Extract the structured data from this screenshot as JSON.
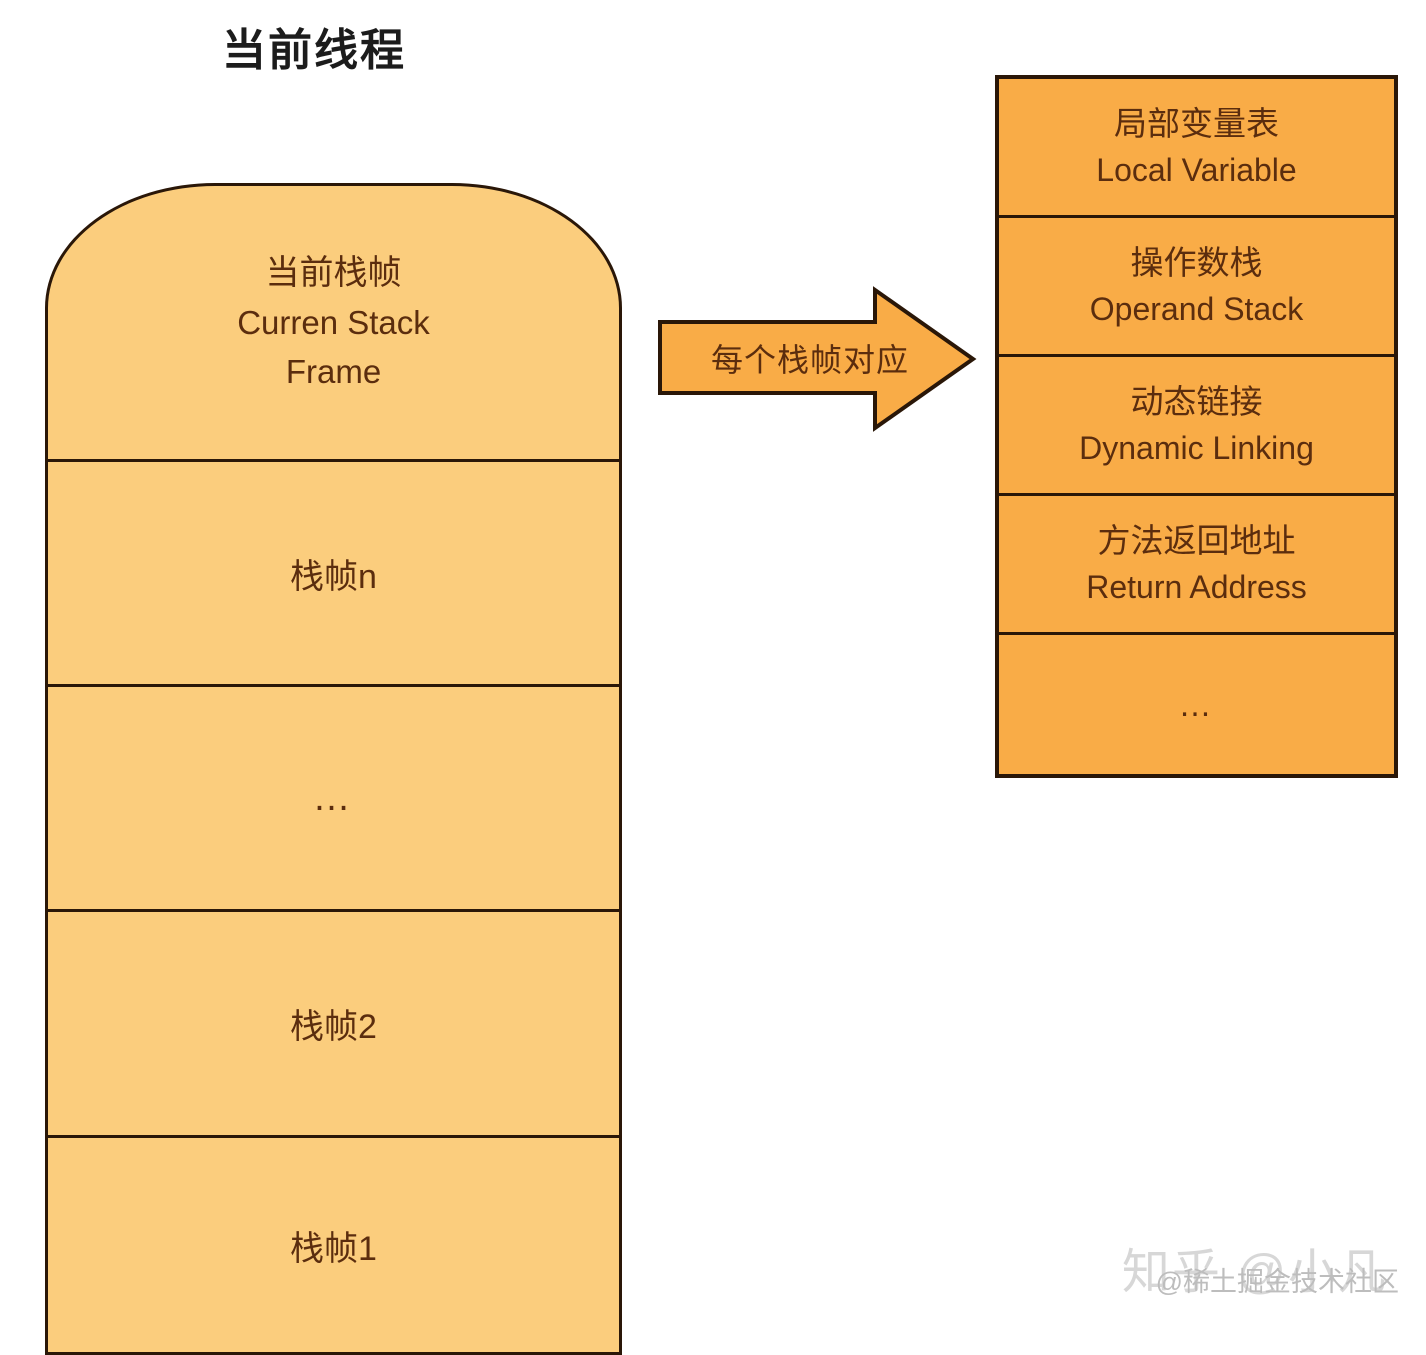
{
  "title": "当前线程",
  "stack": {
    "frames": [
      {
        "zh": "当前栈帧",
        "en": "Curren Stack Frame"
      },
      {
        "label": "栈帧n"
      },
      {
        "label": "…"
      },
      {
        "label": "栈帧2"
      },
      {
        "label": "栈帧1"
      }
    ]
  },
  "arrow": {
    "label": "每个栈帧对应"
  },
  "frame_detail": {
    "rows": [
      {
        "zh": "局部变量表",
        "en": "Local Variable"
      },
      {
        "zh": "操作数栈",
        "en": "Operand Stack"
      },
      {
        "zh": "动态链接",
        "en": "Dynamic Linking"
      },
      {
        "zh": "方法返回地址",
        "en": "Return Address"
      },
      {
        "zh": "…",
        "en": ""
      }
    ]
  },
  "watermarks": {
    "zhihu": "知乎 @小凡",
    "juejin": "@稀土掘金技术社区"
  },
  "colors": {
    "stack_fill": "#FBCD7D",
    "detail_fill": "#F9AC47",
    "line": "#2A1708",
    "text_dark": "#5B2D0E",
    "title_color": "#1C1C1C",
    "wm_light": "#D7D7D7",
    "wm_mid": "#BDBDBD"
  }
}
